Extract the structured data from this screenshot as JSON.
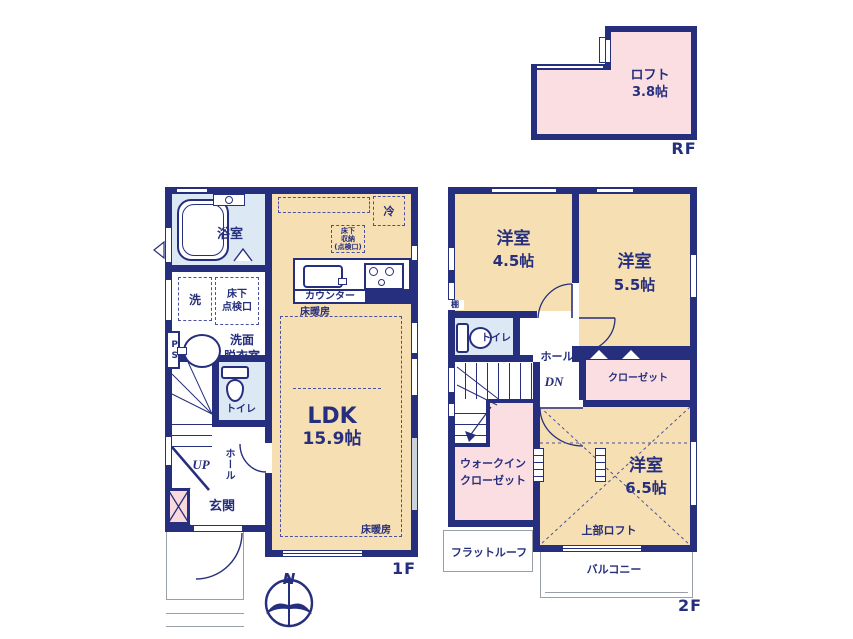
{
  "palette": {
    "wall_navy": "#262f7d",
    "room_tan": "#f6dfb2",
    "water_blue": "#dce8f4",
    "closet_pink": "#fbdee2",
    "entrance_pink": "#f9d9dc",
    "outline_gray": "#9aa0a8"
  },
  "rf": {
    "floor_label": "RF",
    "loft_name": "ロフト",
    "loft_size": "3.8帖"
  },
  "f1": {
    "floor_label": "1F",
    "bath": "浴室",
    "washer": "洗",
    "underfloor_hatch": "床下\n点検口",
    "pipe_space": "PS",
    "washroom": "洗面\n脱衣室",
    "toilet": "トイレ",
    "hall": "ホール",
    "stairs_up": "UP",
    "entrance": "玄関",
    "ldk_name": "LDK",
    "ldk_size": "15.9帖",
    "counter": "カウンター",
    "floor_heating_kitchen": "床暖房",
    "floor_heating_living": "床暖房",
    "fridge": "冷",
    "underfloor_storage": "床下\n収納\n(点検口)"
  },
  "f2": {
    "floor_label": "2F",
    "room_a_name": "洋室",
    "room_a_size": "4.5帖",
    "room_b_name": "洋室",
    "room_b_size": "5.5帖",
    "room_c_name": "洋室",
    "room_c_size": "6.5帖",
    "toilet": "トイレ",
    "shelf": "棚",
    "hall": "ホール",
    "stairs_down": "DN",
    "closet": "クローゼット",
    "walk_in_closet": "ウォークイン\nクローゼット",
    "upper_loft": "上部ロフト",
    "flat_roof": "フラットルーフ",
    "balcony": "バルコニー"
  },
  "compass": {
    "north": "N"
  }
}
